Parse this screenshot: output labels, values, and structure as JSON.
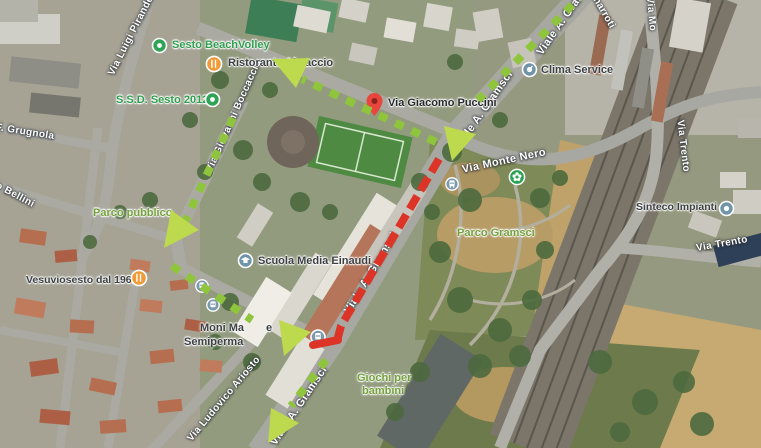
{
  "colors": {
    "route-green": "#8fc53c",
    "route-arrow": "#bdd94d",
    "route-red": "#dc3427",
    "park-text": "#74a13e",
    "sport-text": "#2f9e4f",
    "poi-text": "#3d4043",
    "street-text": "#ffffff",
    "marker-orange": "#f09b38",
    "marker-service": "#7195a8",
    "marker-sport": "#2fa457",
    "marker-park": "#27a353",
    "marker-bus": "#7b99ad",
    "marker-pin": "#e8453c"
  },
  "pois": {
    "beachvolley": "Sesto BeachVolley",
    "ssd": "S.S.D. Sesto 2012",
    "ristorante_prefix": "Ristorante Al",
    "ristorante_suffix": "accio",
    "puccini": "Via Giacomo Puccini",
    "clima": "Clima Service",
    "scuola": "Scuola Media Einaudi",
    "sinteco": "Sinteco Impianti",
    "vesuvio": "Vesuviosesto dal 1961",
    "moni_line1": "Moni Ma",
    "moni_line1_end": "e",
    "moni_line2": "Semiperma"
  },
  "parks": {
    "parco_pubblico": "Parco pubblico",
    "parco_gramsci": "Parco Gramsci",
    "giochi_line1": "Giochi per",
    "giochi_line2": "bambini"
  },
  "streets": {
    "pirandello": "Via Luigi Pirandello",
    "grugnola": "F. Grugnola",
    "bellini": "o Bellini",
    "boccaccio": "Via Giovanni Boccaccio",
    "gramsci_top": "Viale A. Gramsci",
    "gramsci_upper": "Viale A. Gramsci",
    "gramsci_mid": "Viale A. Gramsci",
    "gramsci_bottom": "Viale A. Gramsci",
    "monte_nero": "Via Monte Nero",
    "buonarroti_frag": "narroti",
    "via_mo_frag": "Via Mo",
    "trento_upper": "Via Trento",
    "trento_lower": "Via Trento",
    "ariosto": "Via Ludovico Ariosto"
  }
}
